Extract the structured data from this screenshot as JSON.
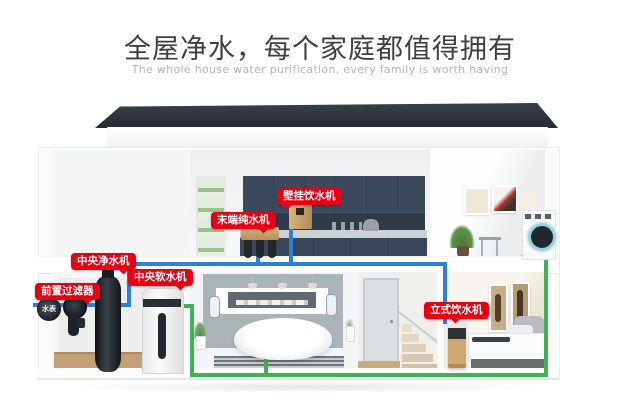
{
  "header": {
    "title": "全屋净水，每个家庭都值得拥有",
    "subtitle": "The whole house water purification, every family is worth having"
  },
  "diagram": {
    "labels": [
      {
        "id": "wall-dispenser",
        "text": "壁挂饮水机"
      },
      {
        "id": "terminal-purifier",
        "text": "末端纯水机"
      },
      {
        "id": "central-purifier",
        "text": "中央净水机"
      },
      {
        "id": "central-softener",
        "text": "中央软水机"
      },
      {
        "id": "pre-filter",
        "text": "前置过滤器"
      },
      {
        "id": "standing-dispenser",
        "text": "立式饮水机"
      },
      {
        "id": "water-meter",
        "text": "水表"
      }
    ],
    "colors": {
      "label_bg": "#e60113",
      "pipe_raw_water": "#2a82d8",
      "pipe_soft_water": "#3fb257",
      "roof": "#2b3039",
      "cabinet_blue": "#3d4a5e",
      "appliance_gold": "#c9a470"
    }
  }
}
